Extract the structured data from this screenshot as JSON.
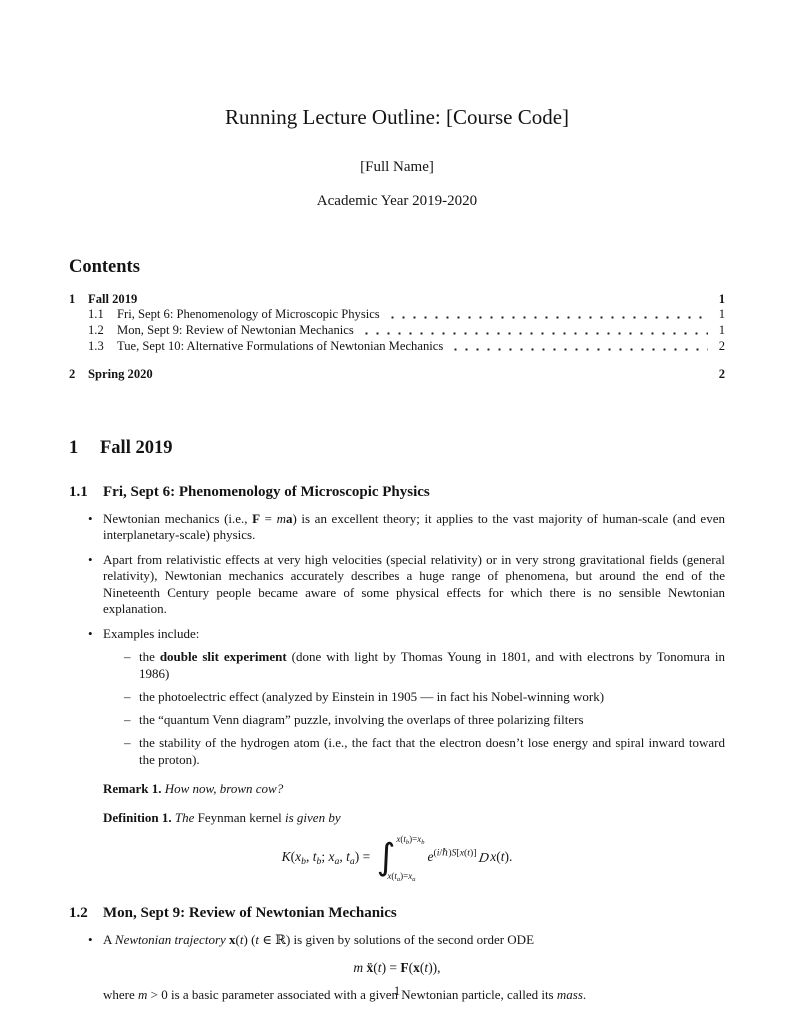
{
  "doc": {
    "title": "Running Lecture Outline: [Course Code]",
    "author": "[Full Name]",
    "date": "Academic Year 2019-2020",
    "page_number": "1"
  },
  "markers": {
    "bullet": "•",
    "dash": "–"
  },
  "toc": {
    "heading": "Contents",
    "entries": [
      {
        "number": "1",
        "title": "Fall 2019",
        "page": "1"
      },
      {
        "number": "1.1",
        "title": "Fri, Sept 6: Phenomenology of Microscopic Physics",
        "page": "1"
      },
      {
        "number": "1.2",
        "title": "Mon, Sept 9: Review of Newtonian Mechanics",
        "page": "1"
      },
      {
        "number": "1.3",
        "title": "Tue, Sept 10: Alternative Formulations of Newtonian Mechanics",
        "page": "2"
      },
      {
        "number": "2",
        "title": "Spring 2020",
        "page": "2"
      }
    ]
  },
  "section1": {
    "number": "1",
    "title": "Fall 2019"
  },
  "sec11": {
    "number": "1.1",
    "title": "Fri, Sept 6: Phenomenology of Microscopic Physics",
    "bullet1": [
      {
        "t": "Newtonian mechanics (i.e., "
      },
      {
        "t": "F",
        "s": "mb"
      },
      {
        "t": " = "
      },
      {
        "t": "m",
        "s": "mi"
      },
      {
        "t": "a",
        "s": "mb"
      },
      {
        "t": ") is an excellent theory; it applies to the vast majority of human-scale (and even interplanetary-scale) physics."
      }
    ],
    "bullet2": [
      {
        "t": "Apart from relativistic effects at very high velocities (special relativity) or in very strong gravitational fields (general relativity), Newtonian mechanics accurately describes a huge range of phenomena, but around the end of the Nineteenth Century people became aware of some physical effects for which there is no sensible Newtonian explanation."
      }
    ],
    "bullet3": [
      {
        "t": "Examples include:"
      }
    ],
    "sub1": [
      {
        "t": "the "
      },
      {
        "t": "double slit experiment",
        "s": "b"
      },
      {
        "t": " (done with light by Thomas Young in 1801, and with electrons by Tonomura in 1986)"
      }
    ],
    "sub2": [
      {
        "t": "the photoelectric effect (analyzed by Einstein in 1905 — in fact his Nobel-winning work)"
      }
    ],
    "sub3": [
      {
        "t": "the “quantum Venn diagram” puzzle, involving the overlaps of three polarizing filters"
      }
    ],
    "sub4": [
      {
        "t": "the stability of the hydrogen atom (i.e., the fact that the electron doesn’t lose energy and spiral inward toward the proton)."
      }
    ],
    "remark": [
      {
        "t": "Remark 1.",
        "s": "b"
      },
      {
        "t": " "
      },
      {
        "t": "How now, brown cow?",
        "s": "i"
      }
    ],
    "definition": [
      {
        "t": "Definition 1.",
        "s": "b"
      },
      {
        "t": " "
      },
      {
        "t": "The",
        "s": "i"
      },
      {
        "t": " Feynman kernel "
      },
      {
        "t": "is given by",
        "s": "i"
      }
    ],
    "kernel_equation": [
      {
        "t": "K",
        "s": "mi"
      },
      {
        "t": "("
      },
      {
        "t": "x",
        "s": "mi"
      },
      {
        "t": "b",
        "s": "sub mi"
      },
      {
        "t": ", "
      },
      {
        "t": "t",
        "s": "mi"
      },
      {
        "t": "b",
        "s": "sub mi"
      },
      {
        "t": "; "
      },
      {
        "t": "x",
        "s": "mi"
      },
      {
        "t": "a",
        "s": "sub mi"
      },
      {
        "t": ", "
      },
      {
        "t": "t",
        "s": "mi"
      },
      {
        "t": "a",
        "s": "sub mi"
      },
      {
        "t": ") = "
      },
      {
        "s": "int-wrap",
        "r": [
          {
            "t": "∫",
            "s": "int-sign"
          },
          {
            "s": "int-limits",
            "r": [
              {
                "s": "upper",
                "r": [
                  {
                    "t": "x",
                    "s": "mi"
                  },
                  {
                    "t": "("
                  },
                  {
                    "t": "t",
                    "s": "mi"
                  },
                  {
                    "t": "b",
                    "s": "sub mi"
                  },
                  {
                    "t": ")="
                  },
                  {
                    "t": "x",
                    "s": "mi"
                  },
                  {
                    "t": "b",
                    "s": "sub mi"
                  }
                ]
              },
              {
                "s": "lower",
                "r": [
                  {
                    "t": "x",
                    "s": "mi"
                  },
                  {
                    "t": "("
                  },
                  {
                    "t": "t",
                    "s": "mi"
                  },
                  {
                    "t": "a",
                    "s": "sub mi"
                  },
                  {
                    "t": ")="
                  },
                  {
                    "t": "x",
                    "s": "mi"
                  },
                  {
                    "t": "a",
                    "s": "sub mi"
                  }
                ]
              }
            ]
          }
        ]
      },
      {
        "t": "e",
        "s": "mi"
      },
      {
        "s": "sup",
        "r": [
          {
            "t": "("
          },
          {
            "t": "i",
            "s": "mi"
          },
          {
            "t": "/"
          },
          {
            "t": "ℏ"
          },
          {
            "t": ")"
          },
          {
            "t": "S",
            "s": "mi"
          },
          {
            "t": "["
          },
          {
            "t": "x",
            "s": "mi"
          },
          {
            "t": "("
          },
          {
            "t": "t",
            "s": "mi"
          },
          {
            "t": ")]"
          }
        ]
      },
      {
        "t": "D",
        "s": "scrD"
      },
      {
        "t": "x",
        "s": "mi"
      },
      {
        "t": "("
      },
      {
        "t": "t",
        "s": "mi"
      },
      {
        "t": ")."
      }
    ]
  },
  "sec12": {
    "number": "1.2",
    "title": "Mon, Sept 9: Review of Newtonian Mechanics",
    "bullet1": [
      {
        "t": "A "
      },
      {
        "t": "Newtonian trajectory",
        "s": "i"
      },
      {
        "t": " "
      },
      {
        "t": "x",
        "s": "mb"
      },
      {
        "t": "("
      },
      {
        "t": "t",
        "s": "mi"
      },
      {
        "t": ") ("
      },
      {
        "t": "t",
        "s": "mi"
      },
      {
        "t": " ∈ ℝ) is given by solutions of the second order ODE"
      }
    ],
    "newton_equation": [
      {
        "t": "m",
        "s": "mi"
      },
      {
        "t": " "
      },
      {
        "t": "ẍ",
        "s": "mb"
      },
      {
        "t": "("
      },
      {
        "t": "t",
        "s": "mi"
      },
      {
        "t": ") = "
      },
      {
        "t": "F",
        "s": "mb"
      },
      {
        "t": "("
      },
      {
        "t": "x",
        "s": "mb"
      },
      {
        "t": "("
      },
      {
        "t": "t",
        "s": "mi"
      },
      {
        "t": ")),"
      }
    ],
    "where": [
      {
        "t": "where "
      },
      {
        "t": "m",
        "s": "mi"
      },
      {
        "t": " > 0 is a basic parameter associated with a given Newtonian particle, called its "
      },
      {
        "t": "mass",
        "s": "i"
      },
      {
        "t": "."
      }
    ]
  }
}
